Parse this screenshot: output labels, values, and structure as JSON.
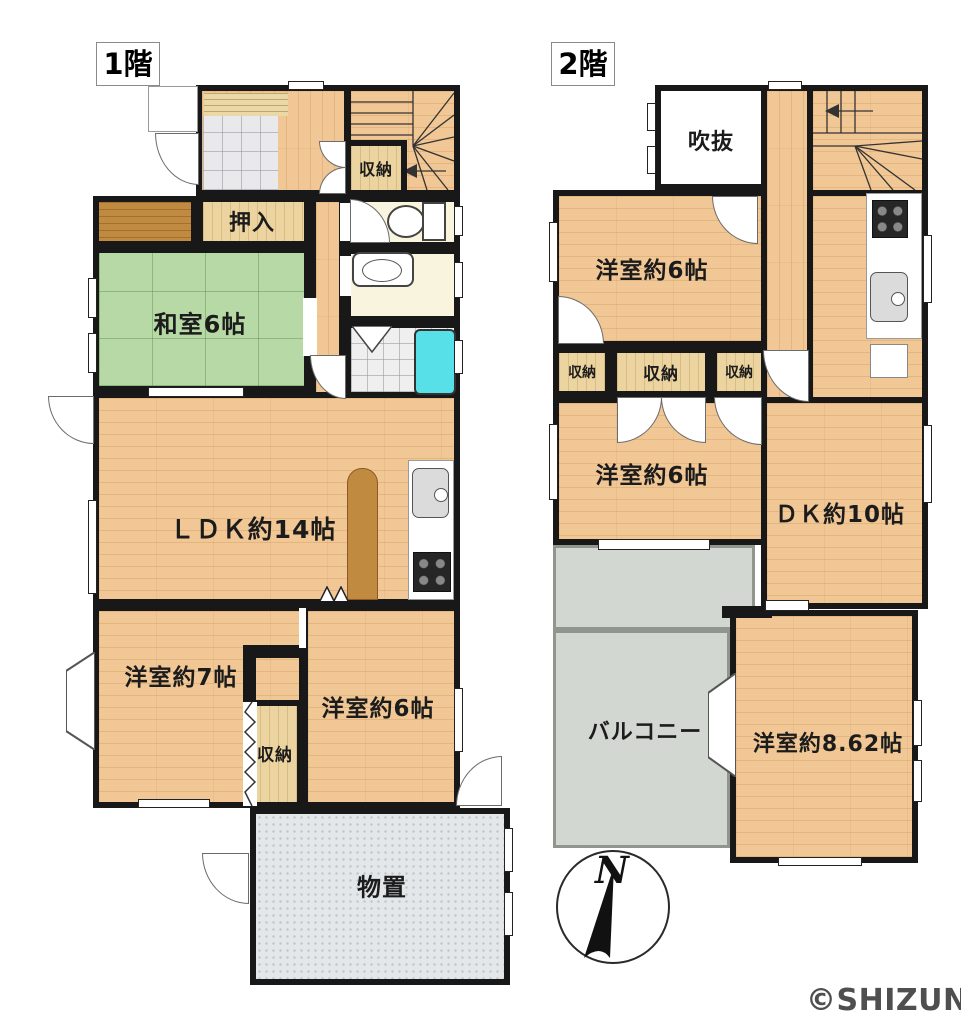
{
  "watermark": "©SHIZUNAVI",
  "compass": {
    "north_label": "N"
  },
  "floor1": {
    "label": "1階",
    "rooms": {
      "stair_closet": "収納",
      "oshiire": "押入",
      "washitsu": "和室6帖",
      "ldk": "ＬＤＫ約14帖",
      "yoshitsu7": "洋室約7帖",
      "yoshitsu6": "洋室約6帖",
      "closet_south": "収納",
      "monooki": "物置"
    }
  },
  "floor2": {
    "label": "2階",
    "rooms": {
      "fukinuke": "吹抜",
      "yoshitsu6_north": "洋室約6帖",
      "closet_a": "収納",
      "closet_b": "収納",
      "closet_c": "収納",
      "yoshitsu6_mid": "洋室約6帖",
      "dk": "ＤＫ約10帖",
      "balcony": "バルコニー",
      "yoshitsu862": "洋室約8.62帖"
    }
  },
  "colors": {
    "wall": "#181818",
    "wood_floor": "#f1c795",
    "tatami_green": "#b6d9a5",
    "closet_tan": "#ecd4a1",
    "bathtub_cyan": "#58e0e9",
    "balcony_gray": "#d3d7d1"
  }
}
